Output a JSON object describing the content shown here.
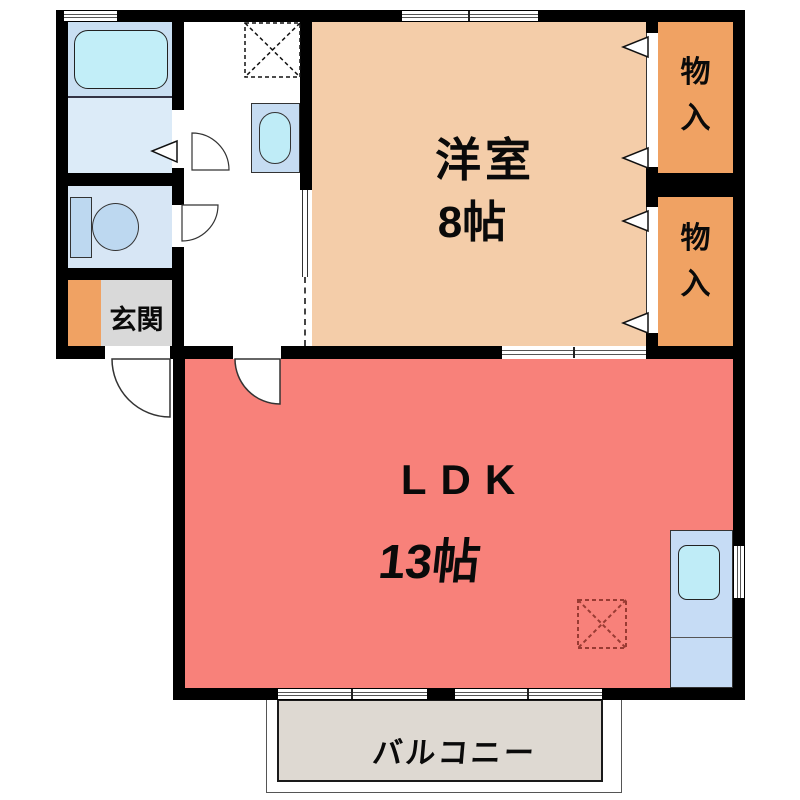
{
  "rooms": {
    "western": {
      "label": "洋室",
      "size": "8帖"
    },
    "ldk": {
      "label": "LDK",
      "size": "13帖"
    },
    "genkan": {
      "label": "玄関"
    },
    "storage_top": {
      "chars": [
        "物",
        "入"
      ]
    },
    "storage_bottom": {
      "chars": [
        "物",
        "入"
      ]
    },
    "balcony": {
      "label": "バルコニー"
    }
  },
  "fixtures": [
    "bathtub",
    "washbasin",
    "toilet",
    "kitchen-sink",
    "washing-machine-space",
    "refrigerator-space"
  ],
  "colors": {
    "wall": "#000000",
    "ldk": "#f8817a",
    "western_room": "#f4cda9",
    "storage": "#f0a263",
    "genkan_step": "#f0a263",
    "genkan_floor": "#d9d9d9",
    "balcony": "#ded9d2",
    "bathroom": "#c9dff2",
    "washroom": "#dcebf8",
    "toilet_room": "#d7e6f5",
    "fixture_water": "#bfecf7",
    "fixture_blue": "#c6dcf2",
    "fridge_mark": "#993b33"
  }
}
